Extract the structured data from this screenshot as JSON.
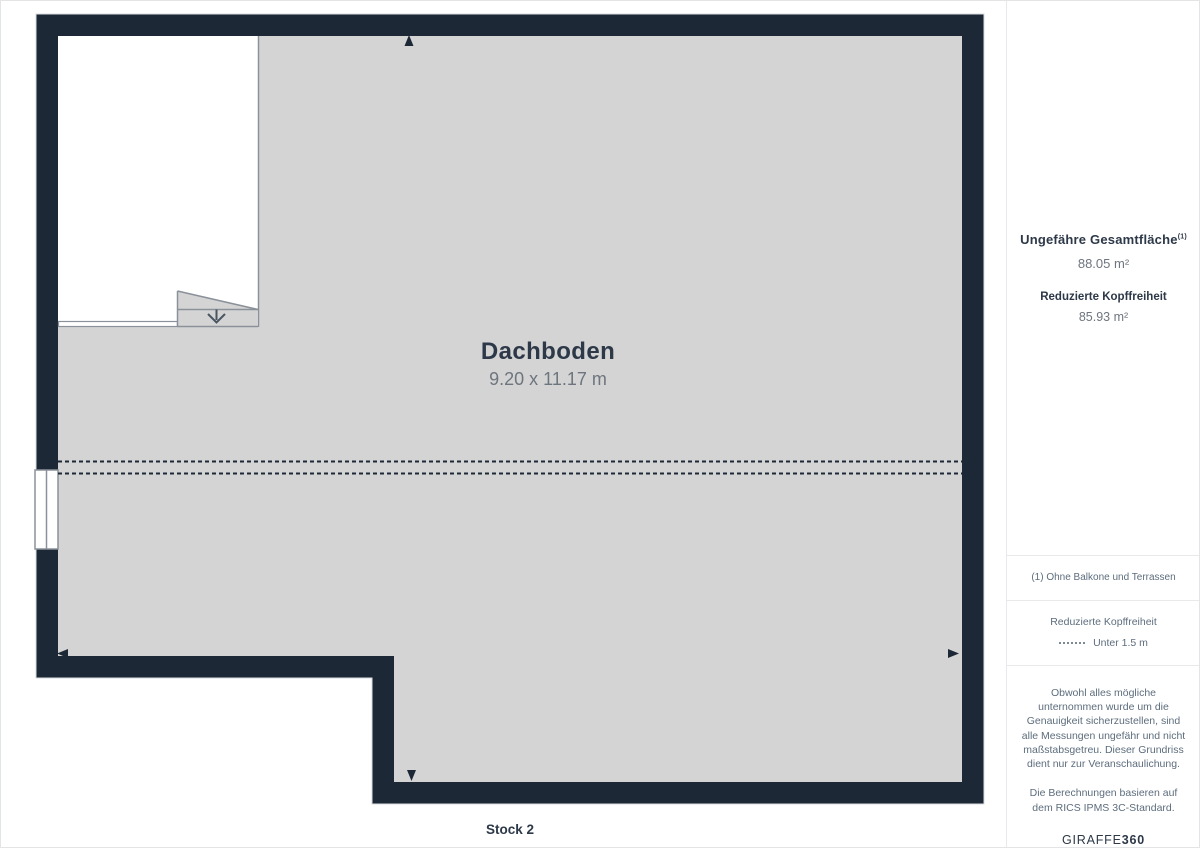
{
  "plan": {
    "room_name": "Dachboden",
    "room_dimensions": "9.20 x 11.17 m",
    "floor_label": "Stock 2"
  },
  "sidebar": {
    "total_area_label": "Ungefähre Gesamtfläche",
    "total_area_footnote_ref": "(1)",
    "total_area_value": "88.05 m²",
    "reduced_headroom_label": "Reduzierte Kopffreiheit",
    "reduced_headroom_value": "85.93 m²",
    "footnote": "(1) Ohne Balkone und Terrassen",
    "legend": {
      "title": "Reduzierte Kopffreiheit",
      "item_label": "Unter 1.5 m"
    },
    "disclaimer_1": "Obwohl alles mögliche unternommen wurde um die Genauigkeit sicherzustellen, sind alle Messungen ungefähr und nicht maßstabsgetreu. Dieser Grundriss dient nur zur Veranschaulichung.",
    "disclaimer_2": "Die Berechnungen basieren auf dem RICS IPMS 3C-Standard.",
    "logo_main": "GIRAFFE",
    "logo_suffix": "360"
  },
  "colors": {
    "wall": "#1d2836",
    "floor": "#d4d4d4",
    "line": "#8b919a",
    "heading": "#2d3848",
    "muted": "#6e757e",
    "sidetext": "#5d6d7d",
    "divider": "#e8e9eb",
    "pageborder": "#e3e4e6"
  }
}
